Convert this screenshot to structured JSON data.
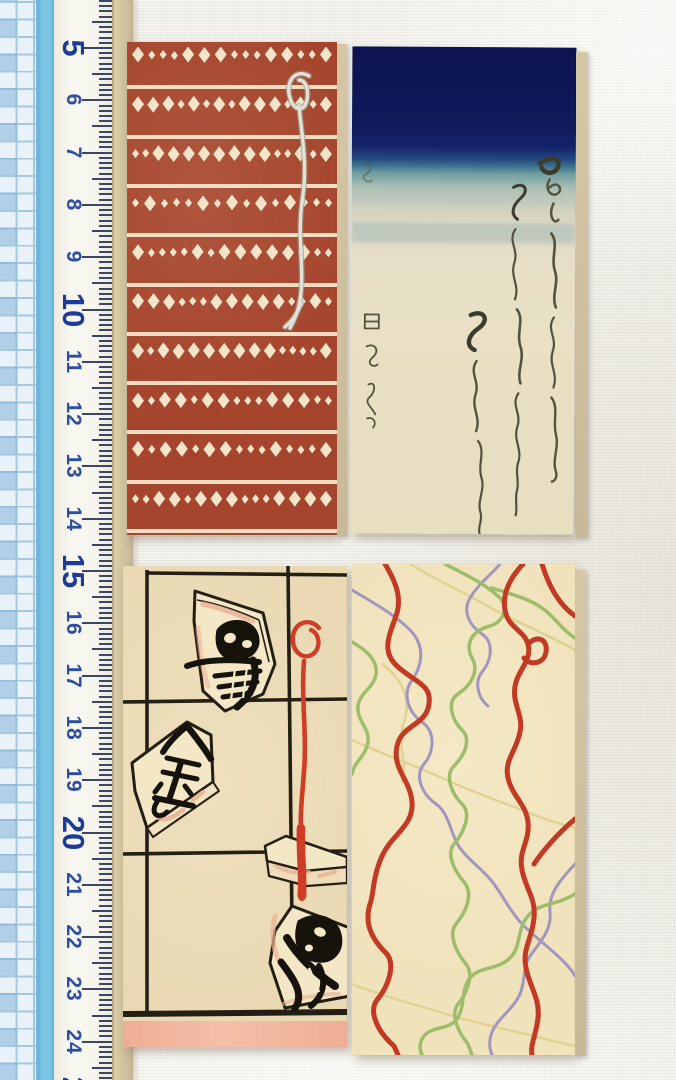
{
  "ruler": {
    "numbers": [
      5,
      6,
      7,
      8,
      9,
      10,
      11,
      12,
      13,
      14,
      15,
      16,
      17,
      18,
      19,
      20,
      21,
      22,
      23,
      24,
      25
    ],
    "major_numbers": [
      5,
      10,
      15,
      20,
      25
    ],
    "first_number": 5,
    "first_y": 48,
    "cm_spacing": 52.3,
    "tick_right_x": 112,
    "tick_len_cm": 30,
    "tick_len_half": 20,
    "tick_len_mm": 13
  },
  "cards": {
    "red_diamond_pattern": {
      "motif_rows": 10,
      "stripe_lines": 11,
      "diamonds_per_row": 15,
      "row_spacing": 49.3,
      "bg_color": "#a6452d",
      "motif_color": "#f4e4c9",
      "string_color": "#e0e1d7"
    },
    "indigo_calligraphy": {
      "sky_color": "#0d1350",
      "sea_color": "#3d7390",
      "paper_color": "#e9e0c5",
      "ink_color": "#53523e"
    },
    "shogi_pieces": {
      "paper_color": "#e9d8b2",
      "grid_color": "#241f15",
      "piece_color": "#f3e7c5",
      "kanji_color": "#16120c",
      "cord_color": "#cf3d26",
      "footer_color": "#efad95"
    },
    "tangled_ribbons": {
      "paper_color": "#f0e2bb",
      "red": "#c23a24",
      "green": "#9dbd6b",
      "purple": "#a396be",
      "yellow": "#dbce85"
    }
  },
  "css_vars": {
    "--cloth": "#f2f1ec",
    "--grid-bg": "#e9f2f8",
    "--grid-line": "#a4c8e0",
    "--grid-dark": "#7db4d8",
    "--stripe": "#7cc5e6",
    "--ruler-body": "#f6f5ee",
    "--tick": "#3c4663",
    "--num": "#2b4da6",
    "--num-major": "#1d3a99",
    "--ruler-edge1": "#dccda9",
    "--ruler-edge2": "#c9bb99",
    "--red-card": "#a6452d",
    "--red-motif": "#f4e4c9",
    "--string-light": "#e0e1d7",
    "--string-dark": "#9c9c92",
    "--cal-paper": "#e9e0c5",
    "--cal-ink": "#53523e",
    "--cal-ink-dark": "#3b3b2e",
    "--shogi-paper": "#e9d8b2",
    "--shogi-line": "#241f15",
    "--piece-fill": "#f3e7c5",
    "--kanji": "#16120c",
    "--blush": "#eab093",
    "--cord": "#cf3d26",
    "--footer-pink": "#efad95",
    "--rib-paper": "#f0e2bb",
    "--rib-red": "#c23a24",
    "--rib-green": "#9dbd6b",
    "--rib-purple": "#a396be",
    "--rib-yellow": "#dbce85",
    "--edge-strip1": "#d5c7a5",
    "--edge-strip2": "#c8ba98"
  }
}
